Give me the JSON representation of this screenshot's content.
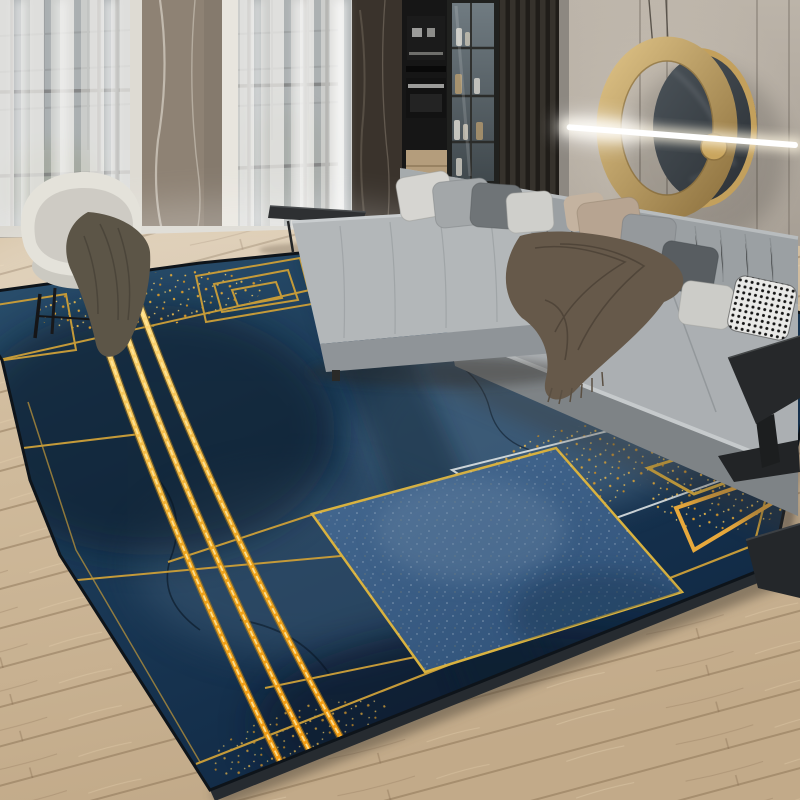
{
  "scene": {
    "description": "Product photo of a modern living room: large navy-blue area rug with gold geometric line pattern and central speckled blue square, grey L-shaped sectional sofa with assorted pillows and a brown fringed throw, cream barrel armchair with olive throw, black side tables, floor-to-ceiling windows with sheer curtains, dark kitchen cabinetry with glass display case, warm greige wall with circular brass-and-marble wall sculpture crossed by a glowing LED light bar, light oak plank flooring",
    "objects": [
      "area-rug",
      "sectional-sofa",
      "ottoman-chaise",
      "throw-pillows",
      "brown-fringed-throw",
      "barrel-armchair",
      "olive-throw-blanket",
      "small-black-coffee-table",
      "black-c-side-table",
      "sheer-curtained-windows",
      "marble-pillar",
      "kitchen-cabinets",
      "glass-display-cabinet",
      "slatted-wood-panel",
      "circular-wall-art",
      "led-light-bar",
      "oak-plank-floor"
    ]
  },
  "palette": {
    "wallTop": "#bcb4a9",
    "wallBot": "#a29a90",
    "groove": "#7a7268",
    "slatDark": "#201d19",
    "slatLight": "#36322c",
    "marbleDark": "#3a332c",
    "marbleLight": "#8e8274",
    "frameWhite": "#dedbd3",
    "curtain": "#ecebe6",
    "glassTop": "#8d98a0",
    "glassBot": "#5c6a6a",
    "greenery": "#6e7a64",
    "applianceBlack": "#161616",
    "steel": "#9c9c9a",
    "woodCab": "#b49d7c",
    "floorTop": "#d8c5a8",
    "floorBot": "#c2aa89",
    "plankSeam": "#7d6448",
    "rugTop": "#2c5270",
    "rugMid": "#1b3a57",
    "rugDeep": "#0e2540",
    "rugSlate": "#5d7d99",
    "rugInk": "#091a2b",
    "goldLine": "#c49a39",
    "goldHi": "#ffe189",
    "goldDeep": "#eda31c",
    "goldOrange": "#f59b13",
    "sqTop": "#466a92",
    "sqBot": "#2f5178",
    "sqBorder": "#d9b23f",
    "whiteLine": "#dde2e3",
    "sofaBack": "#9ba0a3",
    "sofaSeat": "#abafb2",
    "sofaBase": "#7e8386",
    "sofaLight": "#c6cacc",
    "ottoTop": "#b3b7b9",
    "ottoFace": "#8f9498",
    "pleat": "#8a8f92",
    "pillowWhite": "#d6d5d1",
    "pillowGray": "#a3a7a9",
    "pillowDark": "#6f7477",
    "pillowTan": "#b7a491",
    "pillowCharcoal": "#585d61",
    "throwBrown": "#66594a",
    "throwDark": "#4b4136",
    "chairCream": "#e4e2da",
    "chairShade": "#cbc9c1",
    "chairThrow": "#5c5547",
    "legBlack": "#151517",
    "tableBlack": "#26282a",
    "ringGoldA": "#dcc084",
    "ringGoldB": "#8f7340",
    "discDark": "#2a2f34",
    "discLight": "#4c545a",
    "led": "#ffffff",
    "shadow": "#4e4439"
  }
}
